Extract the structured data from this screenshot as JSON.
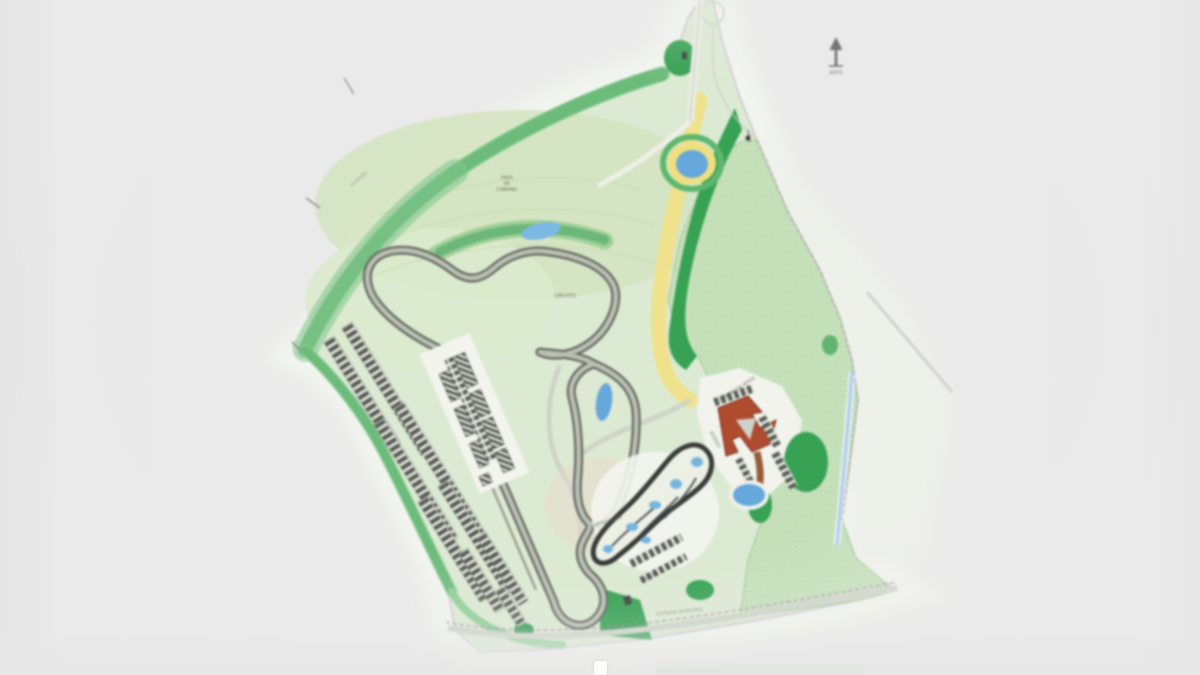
{
  "page": {
    "background": "#e9e9e9"
  },
  "north_arrow": {
    "caption": "NORTE"
  },
  "plan_labels": {
    "camping_line1": "ÁREA",
    "camping_line2": "DE",
    "camping_line3": "CAMPING",
    "infield": "CIRCUITO",
    "kart": "KARTÓDROMO",
    "kart_boxes": "BOXES",
    "support_building": "CENTRO DE APOIO",
    "access": "ACESSO",
    "road_bottom": "ESTRADA MUNICIPAL",
    "road_upper_left": "ESTRADA"
  },
  "colors": {
    "water": "#64a8dd",
    "track": "#666b64",
    "track_fill": "#bbc0b3",
    "forest_dark": "#35a352",
    "forest_light": "#cde4c2",
    "lawn": "#dcead2",
    "vegetation": "#8ecf96",
    "sand_road": "#f1e189",
    "support_red": "#b14a2e",
    "earth_road": "#9a5b37",
    "boundary": "#b07ab0"
  }
}
